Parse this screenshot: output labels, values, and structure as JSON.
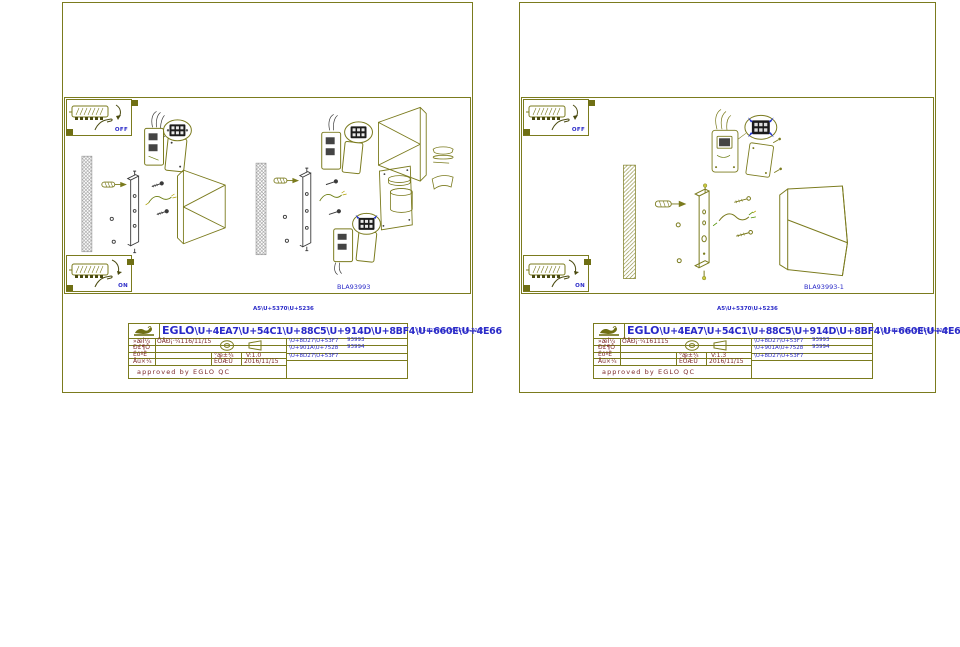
{
  "colors": {
    "line_olive": "#7b7b1e",
    "text_blue": "#2a2ac8",
    "text_maroon": "#7d2a2a",
    "dark_parts": "#3a3a3a",
    "gray_hatch": "#9a9a9a"
  },
  "sheets": [
    {
      "switch_off_label": "OFF",
      "switch_on_label": "ON",
      "drawing_label": "BLA93993",
      "print_size_note": "A5\\U+5370\\U+5236",
      "title_block": {
        "title_brand": "EGLO",
        "title_codes": "\\U+4EA7\\U+54C1\\U+88C5\\U+914D\\U+8BF4\\U+660E\\U+4E66",
        "title_overflow": "\\U+6237\\U+5916\\U+706F",
        "drawn_label": "»æÍ¼",
        "drawn_value": "ÕÅÐ¡·¼116/11/15",
        "check_label": "Ð£¶Ô",
        "audit_label": "ÉóºË",
        "approve_label": "Åú×¼",
        "version_label": "°æ±¾",
        "version_value": "V:1.0",
        "date_label": "ÈÕÆÚ",
        "date_value": "2016/11/15",
        "item_label_1": "\\U+8D27\\U+53F7",
        "item_value_1": "93993",
        "item_value_2": "93994",
        "item_label_2": "\\U+901A\\U+7528",
        "item_label_3": "\\U+8D27\\U+53F7",
        "approved_line": "approved by EGLO QC"
      }
    },
    {
      "switch_off_label": "OFF",
      "switch_on_label": "ON",
      "drawing_label": "BLA93993-1",
      "print_size_note": "A5\\U+5370\\U+5236",
      "title_block": {
        "title_brand": "EGLO",
        "title_codes": "\\U+4EA7\\U+54C1\\U+88C5\\U+914D\\U+8BF4\\U+660E\\U+4E66",
        "title_overflow": "\\U+6237\\U+5916\\U+706F",
        "drawn_label": "»æÍ¼",
        "drawn_value": "ÕÅÐ¡·¼161115",
        "check_label": "Ð£¶Ô",
        "audit_label": "ÉóºË",
        "approve_label": "Åú×¼",
        "version_label": "°æ±¾",
        "version_value": "V:1.3",
        "date_label": "ÈÕÆÚ",
        "date_value": "2016/11/15",
        "item_label_1": "\\U+8D27\\U+53F7",
        "item_value_1": "93993",
        "item_value_2": "93994",
        "item_label_2": "\\U+901A\\U+7528",
        "item_label_3": "\\U+8D27\\U+53F7",
        "approved_line": "approved by EGLO QC"
      }
    }
  ]
}
